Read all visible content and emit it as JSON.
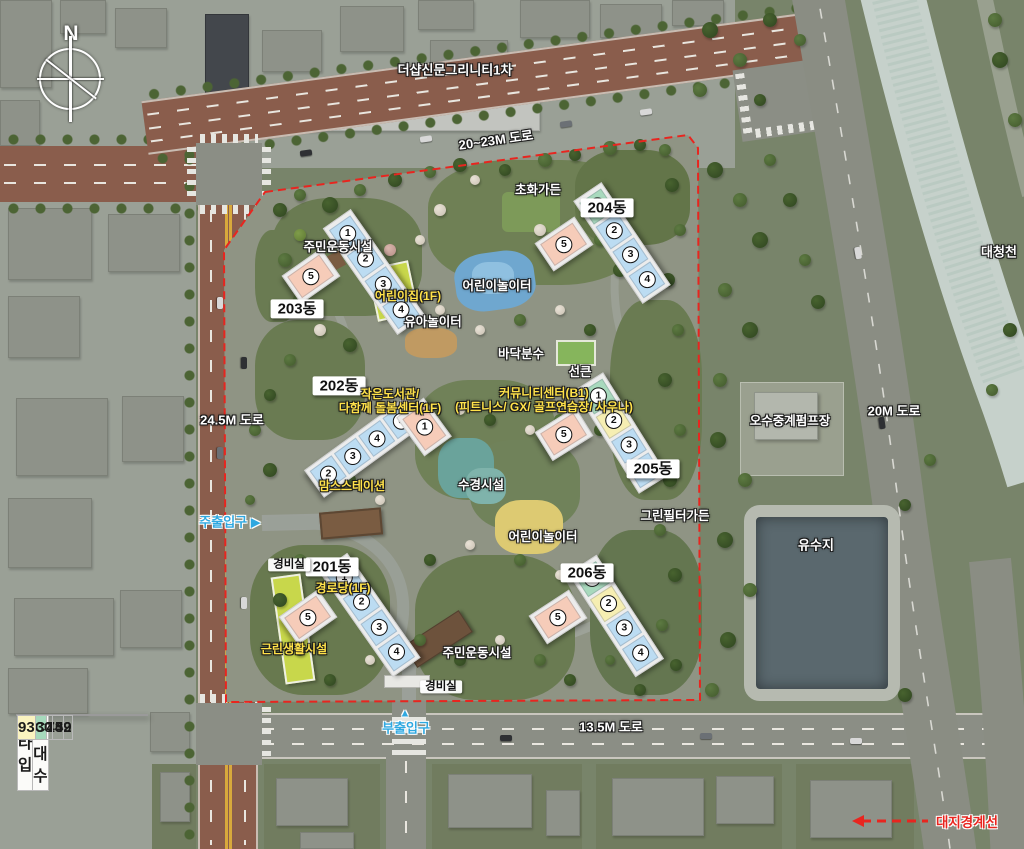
{
  "compass": {
    "label": "N"
  },
  "legend_table": {
    "headers": [
      "타입",
      "세대수"
    ],
    "rows": [
      {
        "type": "84A",
        "count": "452",
        "color": "#bfe3f2"
      },
      {
        "type": "84B",
        "count": "139",
        "color": "#f8cdb4"
      },
      {
        "type": "84C",
        "count": "74",
        "color": "#a6d9bc"
      },
      {
        "type": "93",
        "count": "30",
        "color": "#faf3c0"
      }
    ]
  },
  "unit_type_colors": {
    "84A": "#bcdcf2",
    "84B": "#f6ccb9",
    "84C": "#a8d9bd",
    "93": "#f6eeb2"
  },
  "buildings": [
    {
      "name": "201동",
      "label": {
        "x": 332,
        "y": 567
      },
      "wing": {
        "cx": 370,
        "cy": 615,
        "angle": -35,
        "len": 128,
        "w": 34
      },
      "units": [
        {
          "n": "1",
          "type": "84A"
        },
        {
          "n": "2",
          "type": "84A"
        },
        {
          "n": "3",
          "type": "84A"
        },
        {
          "n": "4",
          "type": "84A"
        }
      ],
      "perp": {
        "cx": 308,
        "cy": 617,
        "angle": 55,
        "n": "5",
        "type": "84B"
      }
    },
    {
      "name": "202동",
      "label": {
        "x": 339,
        "y": 386
      },
      "wing": {
        "cx": 365,
        "cy": 447,
        "angle": 54,
        "len": 126,
        "w": 34
      },
      "units": [
        {
          "n": "5",
          "type": "84A"
        },
        {
          "n": "4",
          "type": "84A"
        },
        {
          "n": "3",
          "type": "84A"
        },
        {
          "n": "2",
          "type": "84A"
        }
      ],
      "perp": {
        "cx": 424,
        "cy": 427,
        "angle": -36,
        "n": "1",
        "type": "84B"
      }
    },
    {
      "name": "203동",
      "label": {
        "x": 297,
        "y": 309
      },
      "wing": {
        "cx": 374,
        "cy": 272,
        "angle": -35,
        "len": 130,
        "w": 34
      },
      "units": [
        {
          "n": "1",
          "type": "84A"
        },
        {
          "n": "2",
          "type": "84A"
        },
        {
          "n": "3",
          "type": "84A"
        },
        {
          "n": "4",
          "type": "84A"
        }
      ],
      "perp": {
        "cx": 311,
        "cy": 276,
        "angle": 55,
        "n": "5",
        "type": "84B"
      }
    },
    {
      "name": "204동",
      "label": {
        "x": 607,
        "y": 208
      },
      "wing": {
        "cx": 622,
        "cy": 243,
        "angle": -34,
        "len": 124,
        "w": 34
      },
      "units": [
        {
          "n": "1",
          "type": "84C"
        },
        {
          "n": "2",
          "type": "84A"
        },
        {
          "n": "3",
          "type": "84A"
        },
        {
          "n": "4",
          "type": "84A"
        }
      ],
      "perp": {
        "cx": 564,
        "cy": 244,
        "angle": 56,
        "n": "5",
        "type": "84B"
      }
    },
    {
      "name": "205동",
      "label": {
        "x": 653,
        "y": 469
      },
      "wing": {
        "cx": 621,
        "cy": 433,
        "angle": -32,
        "len": 122,
        "w": 34
      },
      "units": [
        {
          "n": "1",
          "type": "84C"
        },
        {
          "n": "2",
          "type": "93"
        },
        {
          "n": "3",
          "type": "84A"
        },
        {
          "n": "4",
          "type": "84A"
        }
      ],
      "perp": {
        "cx": 564,
        "cy": 434,
        "angle": 58,
        "n": "5",
        "type": "84B"
      }
    },
    {
      "name": "206동",
      "label": {
        "x": 587,
        "y": 573
      },
      "wing": {
        "cx": 616,
        "cy": 616,
        "angle": -33,
        "len": 124,
        "w": 34
      },
      "units": [
        {
          "n": "1",
          "type": "84C"
        },
        {
          "n": "2",
          "type": "93"
        },
        {
          "n": "3",
          "type": "84A"
        },
        {
          "n": "4",
          "type": "84A"
        }
      ],
      "perp": {
        "cx": 558,
        "cy": 617,
        "angle": 57,
        "n": "5",
        "type": "84B"
      }
    }
  ],
  "labels": [
    {
      "name": "neighbor-complex",
      "text": "더샵신문그리니티1차",
      "x": 455,
      "y": 71,
      "kind": "white",
      "size": 13
    },
    {
      "name": "road-20-23m",
      "text": "20~23M 도로",
      "x": 496,
      "y": 141,
      "kind": "white",
      "rot": -8,
      "size": 13
    },
    {
      "name": "road-24-5m",
      "text": "24.5M 도로",
      "x": 232,
      "y": 421,
      "kind": "white",
      "size": 13
    },
    {
      "name": "road-13-5m",
      "text": "13.5M 도로",
      "x": 611,
      "y": 728,
      "kind": "white",
      "size": 13
    },
    {
      "name": "road-20m",
      "text": "20M 도로",
      "x": 894,
      "y": 412,
      "kind": "white",
      "size": 13
    },
    {
      "name": "river-daecheongcheon",
      "text": "대청천",
      "x": 999,
      "y": 253,
      "kind": "white",
      "size": 13
    },
    {
      "name": "reservoir",
      "text": "유수지",
      "x": 816,
      "y": 546,
      "kind": "white",
      "size": 13
    },
    {
      "name": "pump-station",
      "text": "오수중계펌프장",
      "x": 790,
      "y": 421,
      "kind": "white",
      "size": 12.5
    },
    {
      "name": "flower-garden",
      "text": "초화가든",
      "x": 538,
      "y": 190,
      "kind": "white",
      "size": 12.5
    },
    {
      "name": "playground-north",
      "text": "어린이놀이터",
      "x": 497,
      "y": 286,
      "kind": "white",
      "size": 12.5
    },
    {
      "name": "toddler-playground",
      "text": "유아놀이터",
      "x": 433,
      "y": 322,
      "kind": "white",
      "size": 12.5
    },
    {
      "name": "floor-fountain",
      "text": "바닥분수",
      "x": 521,
      "y": 354,
      "kind": "white",
      "size": 12.5
    },
    {
      "name": "sunken",
      "text": "선큰",
      "x": 580,
      "y": 372,
      "kind": "white",
      "size": 12.5
    },
    {
      "name": "water-feature",
      "text": "수경시설",
      "x": 481,
      "y": 485,
      "kind": "white",
      "size": 12.5
    },
    {
      "name": "playground-south",
      "text": "어린이놀이터",
      "x": 543,
      "y": 537,
      "kind": "white",
      "size": 12.5
    },
    {
      "name": "green-filter-garden",
      "text": "그린필터가든",
      "x": 675,
      "y": 516,
      "kind": "white",
      "size": 12.5
    },
    {
      "name": "sports-facility-north",
      "text": "주민운동시설",
      "x": 338,
      "y": 247,
      "kind": "white",
      "size": 12.5
    },
    {
      "name": "sports-facility-south",
      "text": "주민운동시설",
      "x": 477,
      "y": 653,
      "kind": "white",
      "size": 12.5
    },
    {
      "name": "guard-post-west",
      "text": "경비실",
      "x": 289,
      "y": 565,
      "kind": "boxsm",
      "size": 11.5
    },
    {
      "name": "guard-post-south",
      "text": "경비실",
      "x": 441,
      "y": 687,
      "kind": "boxsm",
      "size": 11.5
    },
    {
      "name": "daycare",
      "text": "어린이집(1F)",
      "x": 408,
      "y": 297,
      "kind": "yellow",
      "size": 12
    },
    {
      "name": "small-library",
      "text": "작은도서관/",
      "text2": "다함께 돌봄센터(1F)",
      "x": 390,
      "y": 402,
      "kind": "yellow",
      "size": 12
    },
    {
      "name": "community-center",
      "text": "커뮤니티센터(B1)",
      "text2": "(피트니스/ GX/ 골프연습장/ 사우나)",
      "x": 544,
      "y": 401,
      "kind": "yellow",
      "size": 12
    },
    {
      "name": "moms-station",
      "text": "맘스스테이션",
      "x": 352,
      "y": 487,
      "kind": "yellow",
      "size": 12
    },
    {
      "name": "senior-center",
      "text": "경로당(1F)",
      "x": 343,
      "y": 589,
      "kind": "yellow",
      "size": 12
    },
    {
      "name": "neighborhood-facility",
      "text": "근린생활시설",
      "x": 294,
      "y": 650,
      "kind": "yellow",
      "size": 12
    },
    {
      "name": "main-entrance",
      "text": "주출입구 ▶",
      "x": 230,
      "y": 523,
      "kind": "blue",
      "size": 13
    },
    {
      "name": "sub-entrance",
      "text": "부출입구",
      "x": 406,
      "y": 729,
      "kind": "blue",
      "size": 13
    },
    {
      "name": "sub-entrance-arrow-icon",
      "text": "▲",
      "x": 405,
      "y": 714,
      "kind": "blue",
      "size": 11
    },
    {
      "name": "site-boundary-legend",
      "text": "대지경계선",
      "x": 967,
      "y": 823,
      "kind": "red",
      "size": 13.5
    }
  ]
}
